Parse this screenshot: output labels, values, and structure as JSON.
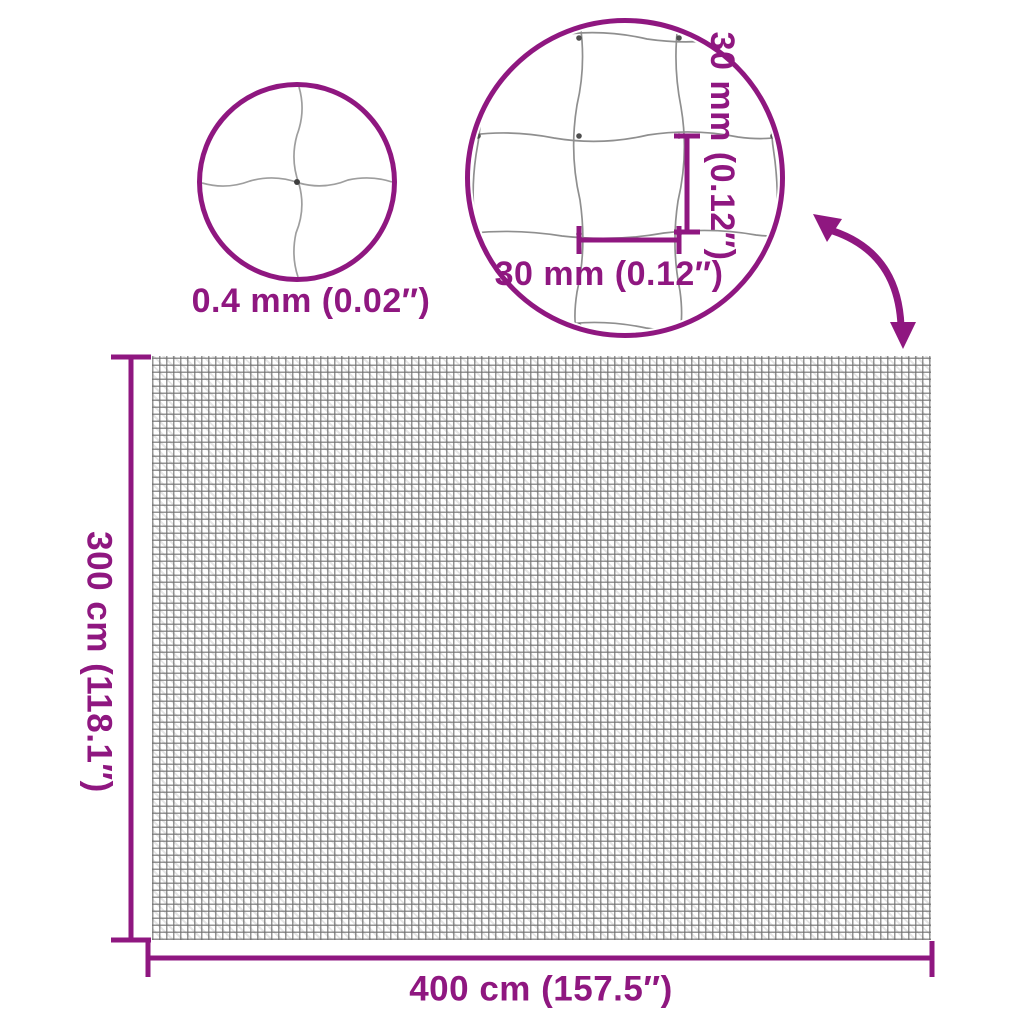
{
  "diagram": {
    "type": "product-dimension-diagram",
    "product": "garden netting / mesh net"
  },
  "colors": {
    "accent": "#8F1780",
    "net_gray": "#919191",
    "knot_gray": "#4F4F4F",
    "background": "#FFFFFF"
  },
  "callouts": {
    "thread": {
      "label": "0.4 mm (0.02″)"
    },
    "mesh": {
      "height_label": "30 mm (0.12″)",
      "width_label": "30 mm (0.12″)"
    }
  },
  "dimensions": {
    "height_label": "300 cm (118.1″)",
    "width_label": "400 cm (157.5″)"
  },
  "icons": [
    {
      "name": "thread-zoom-circle"
    },
    {
      "name": "mesh-zoom-circle"
    },
    {
      "name": "curved-arrow-icon"
    }
  ]
}
